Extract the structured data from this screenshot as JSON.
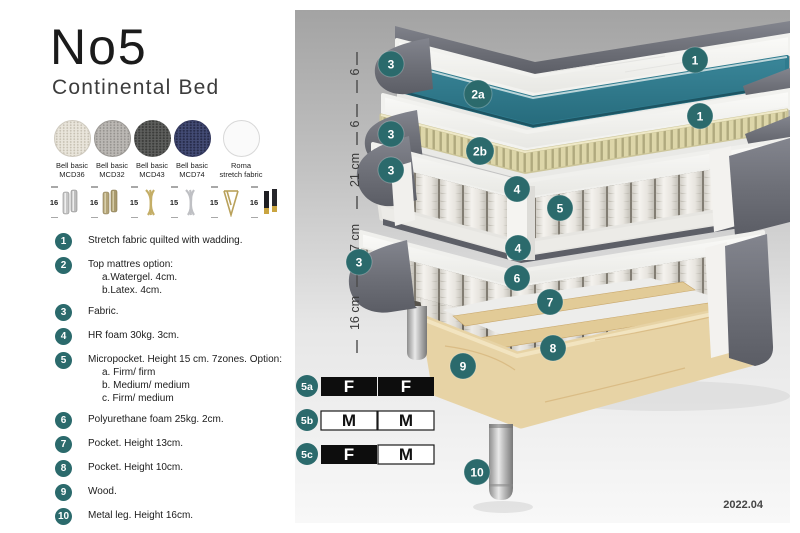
{
  "header": {
    "title": "No5",
    "subtitle": "Continental Bed"
  },
  "fabrics": [
    {
      "line1": "Bell basic",
      "line2": "MCD36",
      "swatch": "cream"
    },
    {
      "line1": "Bell basic",
      "line2": "MCD32",
      "swatch": "light-gray"
    },
    {
      "line1": "Bell basic",
      "line2": "MCD43",
      "swatch": "dark-gray"
    },
    {
      "line1": "Bell basic",
      "line2": "MCD74",
      "swatch": "navy"
    },
    {
      "line1": "Roma",
      "line2": "stretch fabric",
      "swatch": "white"
    }
  ],
  "leg_options": [
    {
      "size": "16",
      "type": "cylinder-silver-leg-icon"
    },
    {
      "size": "16",
      "type": "cylinder-brass-leg-icon"
    },
    {
      "size": "15",
      "type": "twist-gold-leg-icon"
    },
    {
      "size": "15",
      "type": "twist-silver-leg-icon"
    },
    {
      "size": "15",
      "type": "hairpin-gold-leg-icon"
    },
    {
      "size": "16",
      "type": "block-black-gold-leg-icon"
    }
  ],
  "legend": {
    "items": [
      {
        "num": "1",
        "text": "Stretch fabric quilted with wadding.",
        "subs": []
      },
      {
        "num": "2",
        "text": "Top mattres option:",
        "subs": [
          "a.Watergel. 4cm.",
          "b.Latex. 4cm."
        ]
      },
      {
        "num": "3",
        "text": "Fabric.",
        "subs": []
      },
      {
        "num": "4",
        "text": "HR foam 30kg. 3cm.",
        "subs": []
      },
      {
        "num": "5",
        "text": "Micropocket. Height 15 cm. 7zones. Option:",
        "subs": [
          "a. Firm/ firm",
          "b. Medium/ medium",
          "c. Firm/ medium"
        ]
      },
      {
        "num": "6",
        "text": "Polyurethane foam 25kg. 2cm.",
        "subs": []
      },
      {
        "num": "7",
        "text": "Pocket. Height 13cm.",
        "subs": []
      },
      {
        "num": "8",
        "text": "Pocket. Height 10cm.",
        "subs": []
      },
      {
        "num": "9",
        "text": "Wood.",
        "subs": []
      },
      {
        "num": "10",
        "text": "Metal leg. Height 16cm.",
        "subs": []
      }
    ]
  },
  "diagram": {
    "ruler": [
      {
        "label": "6"
      },
      {
        "label": "6"
      },
      {
        "label": "21 cm"
      },
      {
        "label": "27 cm"
      },
      {
        "label": "16 cm"
      }
    ],
    "badges": {
      "b1": "1",
      "b2a": "2a",
      "b2b": "2b",
      "b3": "3",
      "b4": "4",
      "b5": "5",
      "b6": "6",
      "b7": "7",
      "b8": "8",
      "b9": "9",
      "b10": "10"
    },
    "firmness_table": {
      "rows": [
        {
          "id": "5a",
          "left": {
            "label": "F",
            "style": "dark"
          },
          "right": {
            "label": "F",
            "style": "dark"
          }
        },
        {
          "id": "5b",
          "left": {
            "label": "M",
            "style": "light"
          },
          "right": {
            "label": "M",
            "style": "light"
          }
        },
        {
          "id": "5c",
          "left": {
            "label": "F",
            "style": "dark"
          },
          "right": {
            "label": "M",
            "style": "light"
          }
        }
      ]
    },
    "version": "2022.04",
    "colors": {
      "badge_teal": "#2b6a6c",
      "watergel_teal": "#2f7b8e",
      "latex_khaki": "#ded7ab",
      "fabric_gray": "#6e7078",
      "wood_tan": "#e7d3a5"
    }
  }
}
